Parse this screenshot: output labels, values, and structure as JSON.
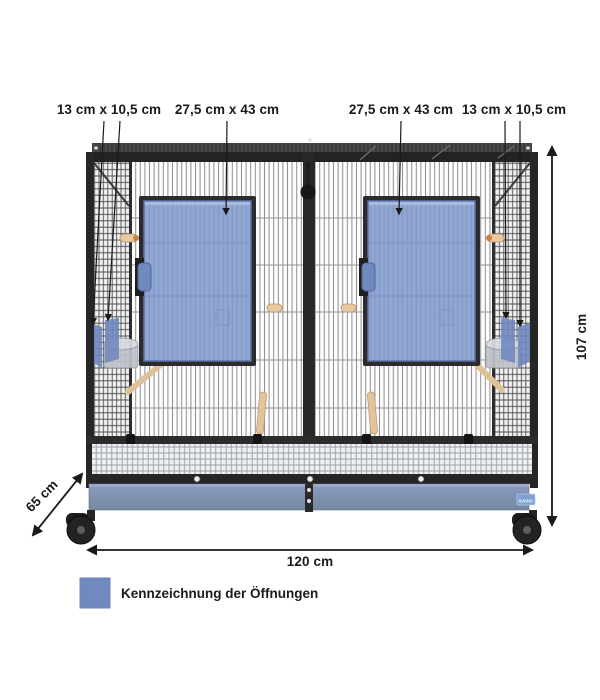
{
  "annotations": {
    "opening_small_left": "13 cm x 10,5 cm",
    "opening_large_left": "27,5 cm x 43 cm",
    "opening_large_right": "27,5 cm x 43 cm",
    "opening_small_right": "13 cm x 10,5 cm",
    "height": "107 cm",
    "width": "120 cm",
    "depth": "65 cm"
  },
  "legend": {
    "swatch_color": "#7089c0",
    "label": "Kennzeichnung der Öffnungen"
  },
  "cage": {
    "brand_badge": "SAVIC",
    "marking_color": "#7089c0",
    "door_panel_color": "#91a7d3",
    "tray_color": "#8093b8",
    "frame_color": "#2a2a2a"
  }
}
